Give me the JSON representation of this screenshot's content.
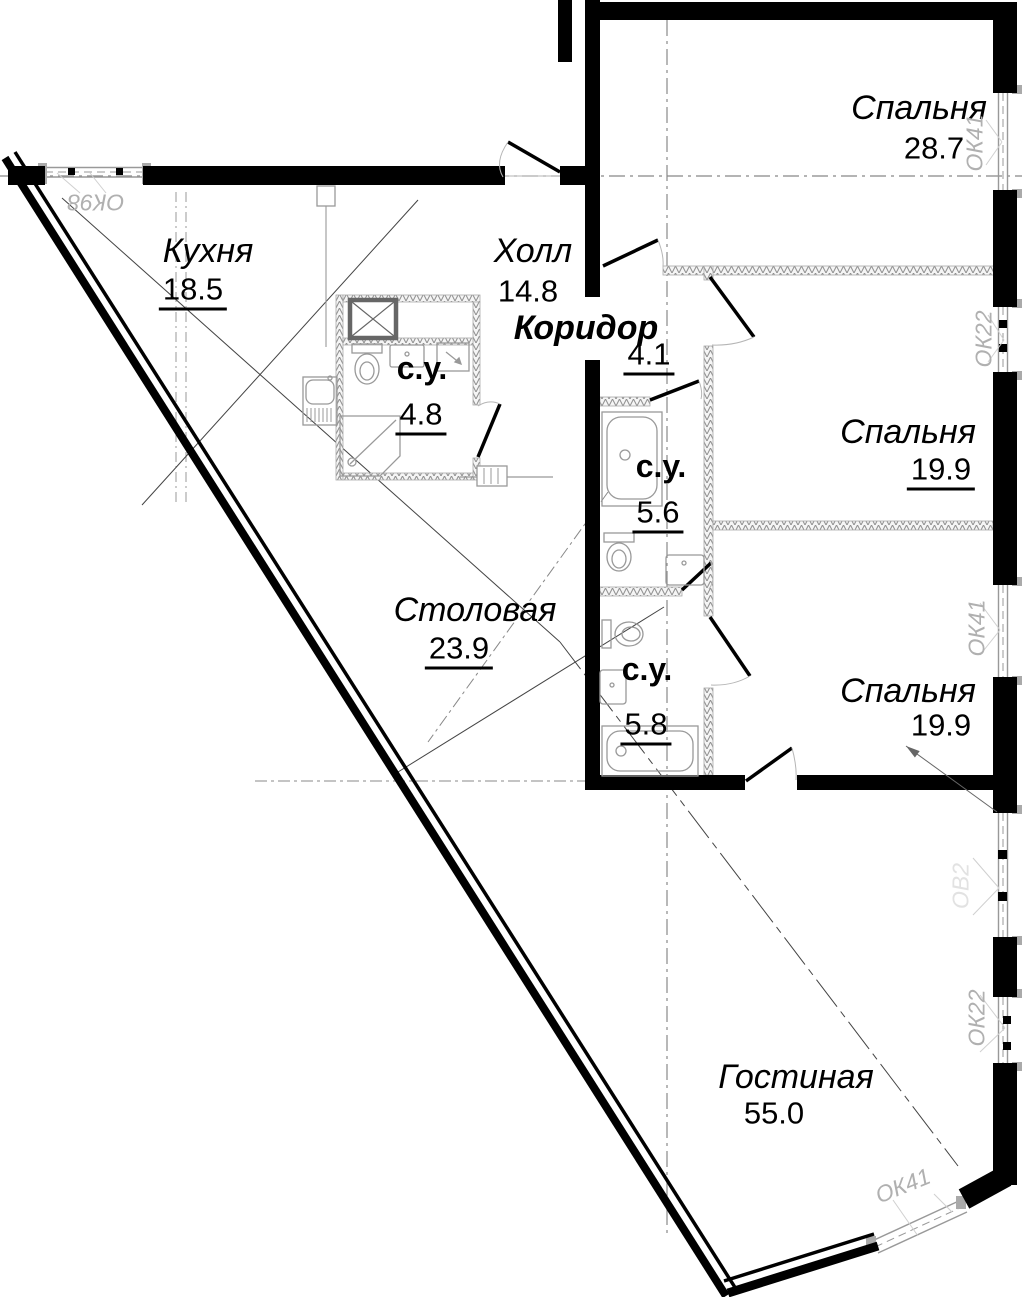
{
  "plan": {
    "rooms": [
      {
        "name": "Спальня",
        "area": "28.7"
      },
      {
        "name": "Кухня",
        "area": "18.5"
      },
      {
        "name": "Холл",
        "area": "14.8"
      },
      {
        "name": "Коридор",
        "area": "4.1"
      },
      {
        "name": "с.у.",
        "area": "4.8"
      },
      {
        "name": "Спальня",
        "area": "19.9"
      },
      {
        "name": "с.у.",
        "area": "5.6"
      },
      {
        "name": "с.у.",
        "area": "5.8"
      },
      {
        "name": "Столовая",
        "area": "23.9"
      },
      {
        "name": "Спальня",
        "area": "19.9"
      },
      {
        "name": "Гостиная",
        "area": "55.0"
      }
    ],
    "window_labels": [
      "ОК98",
      "ОК41",
      "ОК22",
      "ОК41",
      "ОВ2",
      "ОК22",
      "ОК41"
    ],
    "colors": {
      "wall": "#000000",
      "partition": "#8f8f8f",
      "axis": "#888888",
      "window_line": "#999999",
      "window_label": "#b0b0b0",
      "faint_label": "#e2e2e2"
    }
  }
}
